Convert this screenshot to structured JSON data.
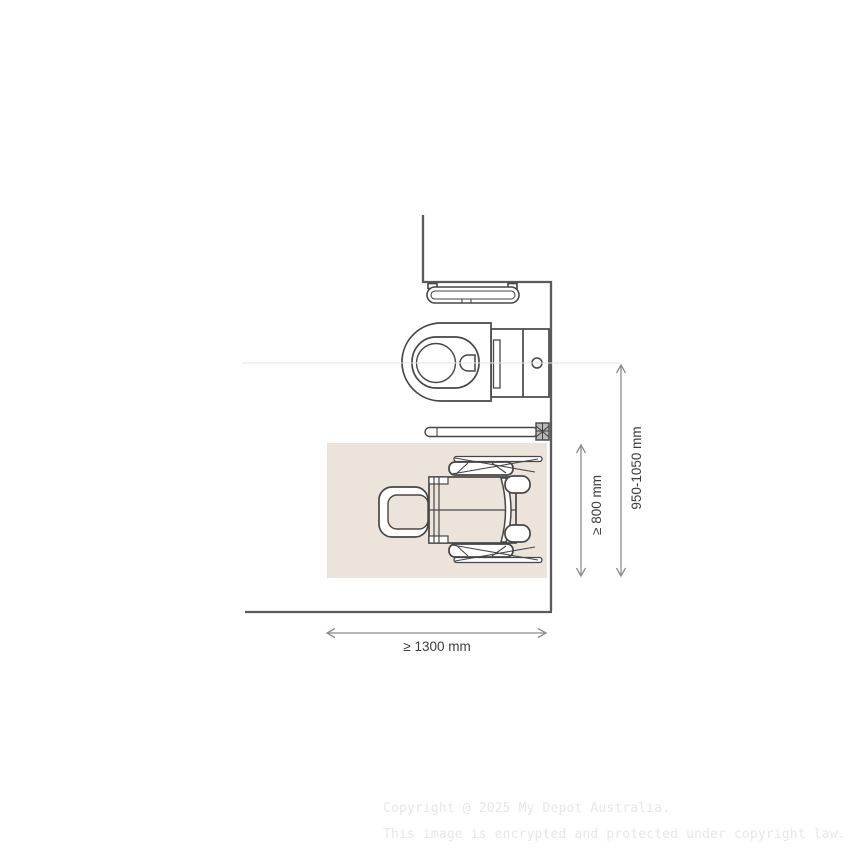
{
  "diagram": {
    "title": "accessible-toilet-clearance-plan",
    "dimensions": {
      "clearance_width": "≥ 1300 mm",
      "clearance_depth": "≥ 800 mm",
      "centerline_range": "950-1050 mm"
    },
    "colors": {
      "line": "#464646",
      "wall": "#5a5a5a",
      "dimension_line": "#8c8c8c",
      "dimension_text": "#3d3d3d",
      "clearance_zone": "#ece4db",
      "centerline": "#e2e2e2",
      "watermark": "#e7e7e7",
      "background": "#ffffff"
    },
    "elements": [
      "wall-outline",
      "rear-grab-rail",
      "toilet-plan-view",
      "fold-down-grab-rail",
      "clearance-zone",
      "wheelchair-plan-view"
    ]
  },
  "watermark": {
    "line1": "Copyright @ 2025 My Depot Australia.",
    "line2": "This image is encrypted and protected under copyright law."
  }
}
